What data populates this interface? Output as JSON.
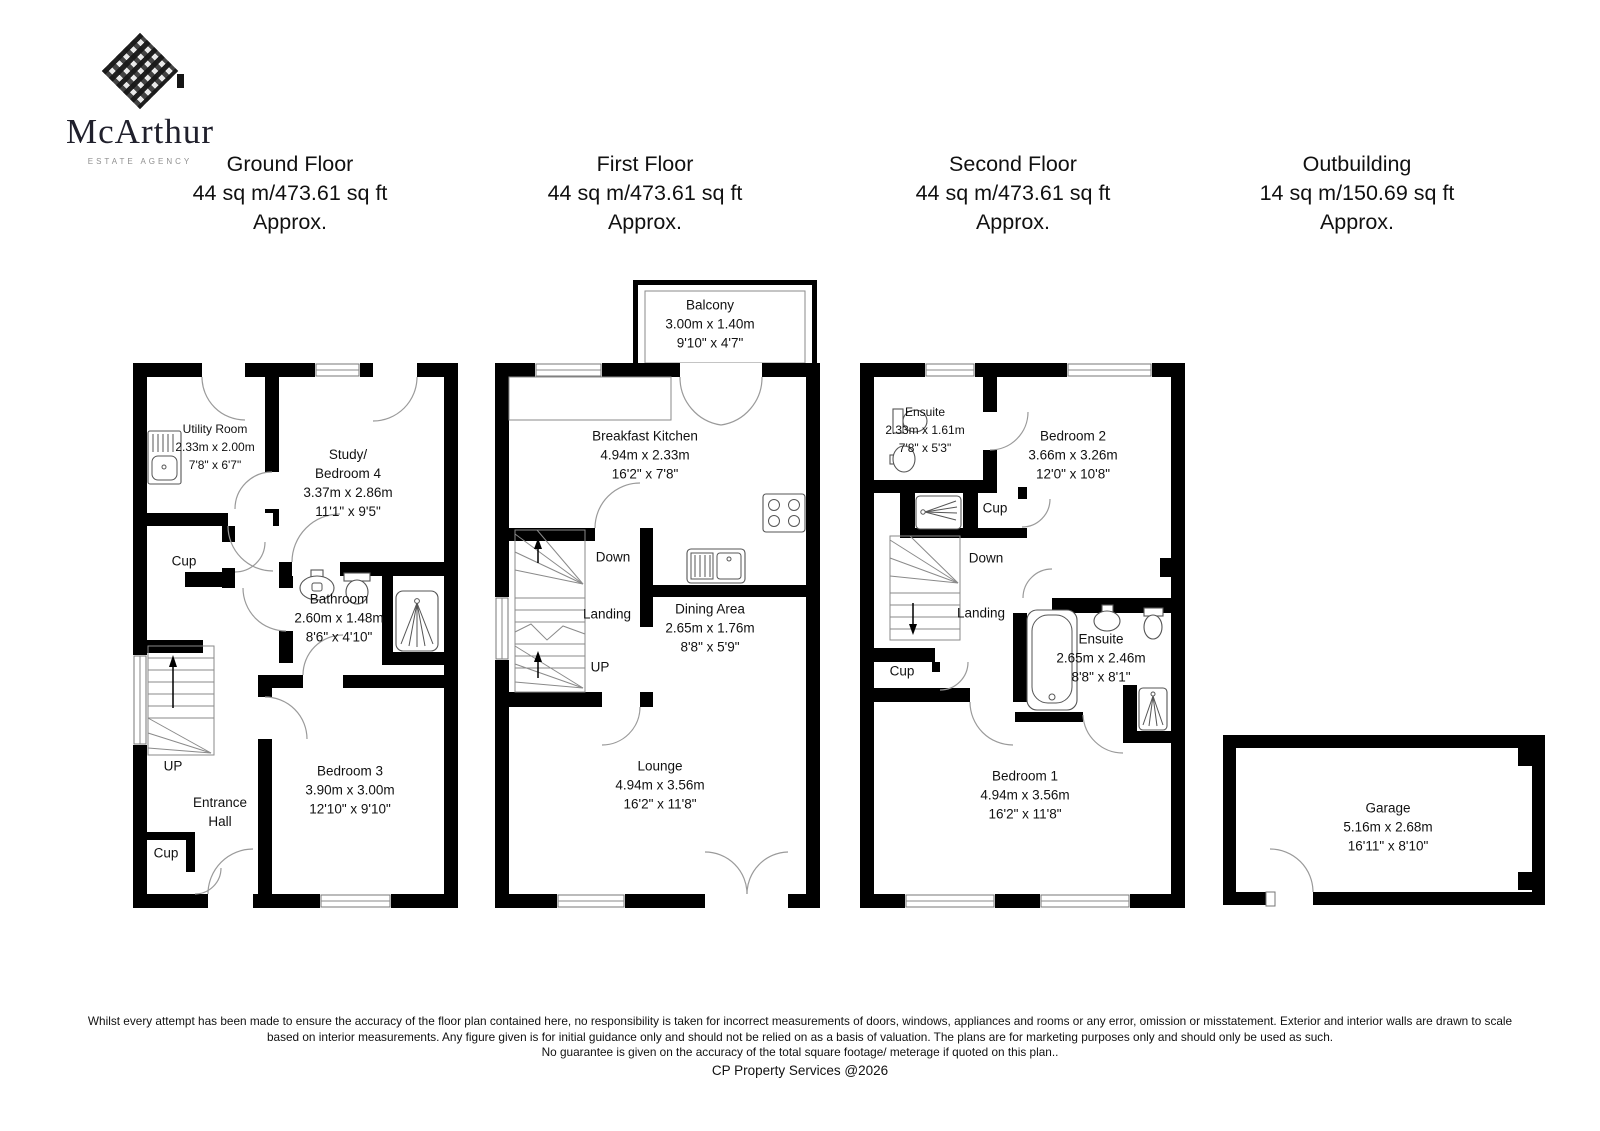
{
  "logo": {
    "name": "McArthur",
    "tagline": "ESTATE AGENCY"
  },
  "floors": [
    {
      "name": "Ground Floor",
      "area": "44 sq m/473.61 sq ft",
      "approx": "Approx."
    },
    {
      "name": "First Floor",
      "area": "44 sq m/473.61 sq ft",
      "approx": "Approx."
    },
    {
      "name": "Second Floor",
      "area": "44 sq m/473.61 sq ft",
      "approx": "Approx."
    },
    {
      "name": "Outbuilding",
      "area": "14 sq m/150.69 sq ft",
      "approx": "Approx."
    }
  ],
  "plans": {
    "ground": {
      "utility": [
        "Utility Room",
        "2.33m x 2.00m",
        "7'8\" x 6'7\""
      ],
      "study": [
        "Study/",
        "Bedroom 4",
        "3.37m x 2.86m",
        "11'1\" x 9'5\""
      ],
      "cup1": "Cup",
      "bathroom": [
        "Bathroom",
        "2.60m x 1.48m",
        "8'6\" x 4'10\""
      ],
      "up": "UP",
      "hall": [
        "Entrance",
        "Hall"
      ],
      "cup2": "Cup",
      "bedroom3": [
        "Bedroom 3",
        "3.90m x 3.00m",
        "12'10\" x 9'10\""
      ]
    },
    "first": {
      "balcony": [
        "Balcony",
        "3.00m x 1.40m",
        "9'10\" x 4'7\""
      ],
      "kitchen": [
        "Breakfast Kitchen",
        "4.94m x 2.33m",
        "16'2\" x 7'8\""
      ],
      "down": "Down",
      "landing": "Landing",
      "up": "UP",
      "dining": [
        "Dining Area",
        "2.65m x 1.76m",
        "8'8\" x 5'9\""
      ],
      "lounge": [
        "Lounge",
        "4.94m x 3.56m",
        "16'2\" x 11'8\""
      ]
    },
    "second": {
      "ensuite1": [
        "Ensuite",
        "2.33m x 1.61m",
        "7'8\" x 5'3\""
      ],
      "bedroom2": [
        "Bedroom 2",
        "3.66m x 3.26m",
        "12'0\" x 10'8\""
      ],
      "cup1": "Cup",
      "down": "Down",
      "landing": "Landing",
      "cup2": "Cup",
      "ensuite2": [
        "Ensuite",
        "2.65m x 2.46m",
        "8'8\" x 8'1\""
      ],
      "bedroom1": [
        "Bedroom 1",
        "4.94m x 3.56m",
        "16'2\" x 11'8\""
      ]
    },
    "outbuilding": {
      "garage": [
        "Garage",
        "5.16m x 2.68m",
        "16'11\" x 8'10\""
      ]
    }
  },
  "footer": {
    "line1": "Whilst every attempt has been made to ensure the accuracy of the floor plan contained here, no responsibility is taken for incorrect measurements of doors, windows, appliances and rooms or any error, omission or misstatement. Exterior and interior walls are drawn to scale",
    "line2": "based on interior measurements. Any figure given is for initial guidance only and should not be relied on as a basis of valuation. The plans are for marketing purposes only and should only be used as such.",
    "line3": "No guarantee is given on the accuracy of the total square footage/ meterage if quoted on this plan..",
    "credit": "CP Property Services @2026"
  }
}
